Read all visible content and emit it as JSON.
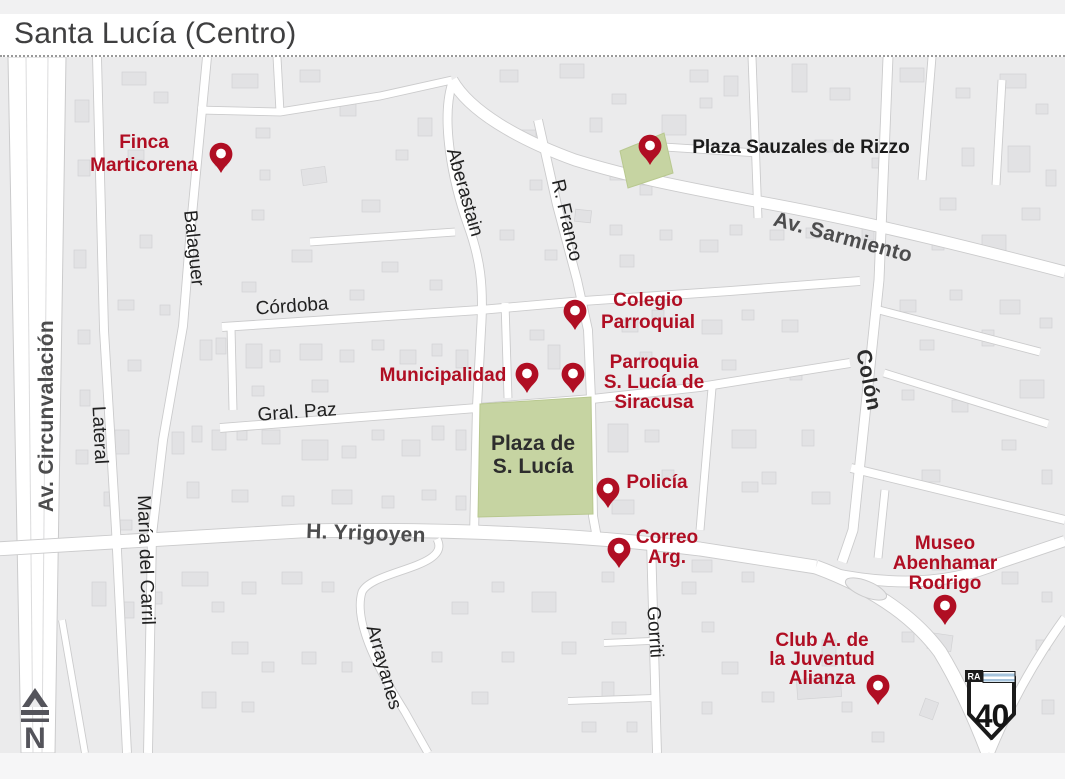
{
  "page": {
    "title": "Santa Lucía (Centro)"
  },
  "colors": {
    "poi_red": "#b00e23",
    "plaza_green": "#c6d4a2",
    "road_white": "#ffffff",
    "map_bg": "#ebebec",
    "flag_blue": "#a6c4dd"
  },
  "map": {
    "street_labels": [
      {
        "id": "av-circunvalacion",
        "text": "Av. Circunvalación",
        "x": 46,
        "y": 416,
        "rot": -90,
        "style": "avenue"
      },
      {
        "id": "lateral",
        "text": "Lateral",
        "x": 101,
        "y": 435,
        "rot": 87,
        "style": "street"
      },
      {
        "id": "balaguer",
        "text": "Balaguer",
        "x": 195,
        "y": 248,
        "rot": 84,
        "style": "street"
      },
      {
        "id": "maria-del-carril",
        "text": "María del Carril",
        "x": 147,
        "y": 560,
        "rot": 88,
        "style": "street"
      },
      {
        "id": "cordoba",
        "text": "Córdoba",
        "x": 292,
        "y": 305,
        "rot": -4,
        "style": "street"
      },
      {
        "id": "gral-paz",
        "text": "Gral. Paz",
        "x": 297,
        "y": 411,
        "rot": -4,
        "style": "street"
      },
      {
        "id": "aberastain",
        "text": "Aberastain",
        "x": 466,
        "y": 192,
        "rot": 74,
        "style": "street"
      },
      {
        "id": "r-franco",
        "text": "R. Franco",
        "x": 568,
        "y": 220,
        "rot": 77,
        "style": "street"
      },
      {
        "id": "av-sarmiento",
        "text": "Av. Sarmiento",
        "x": 843,
        "y": 237,
        "rot": 15,
        "style": "avenue"
      },
      {
        "id": "h-yrigoyen",
        "text": "H. Yrigoyen",
        "x": 366,
        "y": 533,
        "rot": 2,
        "style": "avenue"
      },
      {
        "id": "colon",
        "text": "Colón",
        "x": 869,
        "y": 380,
        "rot": 79,
        "style": "street-bold"
      },
      {
        "id": "gorriti",
        "text": "Gorriti",
        "x": 656,
        "y": 632,
        "rot": 86,
        "style": "street"
      },
      {
        "id": "arrayanes",
        "text": "Arrayanes",
        "x": 385,
        "y": 667,
        "rot": 74,
        "style": "street"
      }
    ],
    "pois": [
      {
        "id": "finca-marticorena",
        "lines": [
          "Finca",
          "Marticorena"
        ],
        "pin": {
          "x": 221,
          "y": 173
        },
        "label": {
          "cx": 144,
          "y": 132,
          "lh": 23
        }
      },
      {
        "id": "plaza-sauzales",
        "lines": [
          "Plaza Sauzales de Rizzo"
        ],
        "pin": {
          "x": 650,
          "y": 165
        },
        "label": {
          "cx": 801,
          "y": 137,
          "lh": 20
        },
        "color": "dark"
      },
      {
        "id": "colegio-parroquial",
        "lines": [
          "Colegio",
          "Parroquial"
        ],
        "pin": {
          "x": 575,
          "y": 330
        },
        "label": {
          "cx": 648,
          "y": 290,
          "lh": 22
        }
      },
      {
        "id": "municipalidad",
        "lines": [
          "Municipalidad"
        ],
        "pin": {
          "x": 527,
          "y": 393
        },
        "label": {
          "cx": 443,
          "y": 365,
          "lh": 20
        }
      },
      {
        "id": "parroquia-s-lucia",
        "lines": [
          "Parroquia",
          "S. Lucía de",
          "Siracusa"
        ],
        "pin": {
          "x": 573,
          "y": 393
        },
        "label": {
          "cx": 654,
          "y": 352,
          "lh": 20
        }
      },
      {
        "id": "policia",
        "lines": [
          "Policía"
        ],
        "pin": {
          "x": 608,
          "y": 508
        },
        "label": {
          "cx": 657,
          "y": 472,
          "lh": 20
        }
      },
      {
        "id": "correo-argentino",
        "lines": [
          "Correo",
          "Arg."
        ],
        "pin": {
          "x": 619,
          "y": 568
        },
        "label": {
          "cx": 667,
          "y": 527,
          "lh": 20
        }
      },
      {
        "id": "museo-abenhamar",
        "lines": [
          "Museo",
          "Abenhamar",
          "Rodrigo"
        ],
        "pin": {
          "x": 945,
          "y": 625
        },
        "label": {
          "cx": 945,
          "y": 533,
          "lh": 20
        }
      },
      {
        "id": "club-juventud",
        "lines": [
          "Club A. de",
          "la Juventud",
          "Alianza"
        ],
        "pin": {
          "x": 878,
          "y": 705
        },
        "label": {
          "cx": 822,
          "y": 630,
          "lh": 19
        }
      }
    ],
    "plaza": {
      "lines": [
        "Plaza de",
        "S. Lucía"
      ]
    },
    "route_shield": {
      "prefix": "RA",
      "number": "40"
    },
    "compass": {
      "letter": "N"
    }
  }
}
